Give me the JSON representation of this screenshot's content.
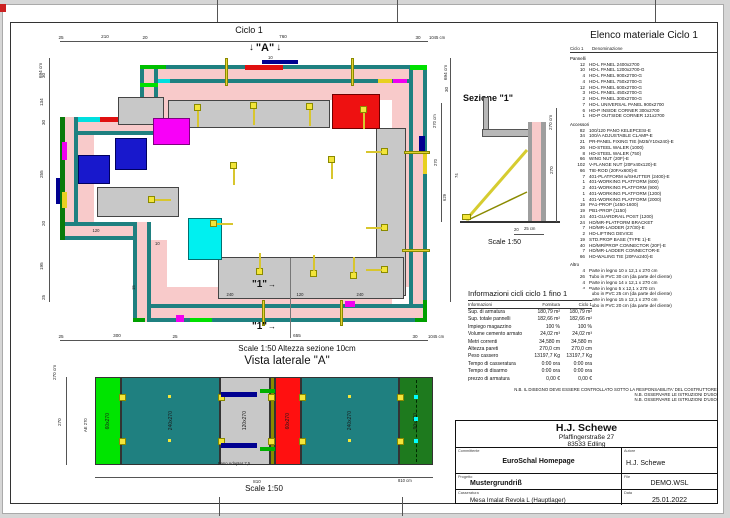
{
  "colors": {
    "teal": "#1F8080",
    "wall_pink": "#F8CACA",
    "bright_green": "#00E000",
    "dark_green": "#1E7A1E",
    "red": "#E01010",
    "magenta": "#F000F0",
    "blue": "#1818CC",
    "navy": "#000090",
    "cyan": "#00E0E0",
    "yellow": "#F3E53A",
    "platform_gray": "#C8C8C8",
    "olive": "#8A8A00"
  },
  "icons": {
    "down_arrow": "↓",
    "right_arrow": "→"
  },
  "sheet": {
    "title_top": "Ciclo 1"
  },
  "plan": {
    "marker_a": "\"A\"",
    "marker_a_dim": "10",
    "marker_1": "\"1\"",
    "top_segs": [
      "25",
      "210",
      "20",
      "760",
      "30"
    ],
    "top_total": "1045 cm",
    "left_total": "694 cm",
    "left_segs": [
      "30",
      "134",
      "30",
      "255",
      "20",
      "195",
      "25"
    ],
    "right_labels": [
      "694 cm",
      "30",
      "270 cm",
      "270",
      "629",
      "74"
    ],
    "bottom_segs": [
      "25",
      "300",
      "25",
      "655",
      "30"
    ],
    "bottom_total": "1045 cm",
    "micro_dims": [
      "10",
      "15",
      "120",
      "240",
      "120",
      "240"
    ],
    "scale_note": "Scale 1:50   Altezza sezione 10cm"
  },
  "sezione": {
    "title": "Sezione \"1\"",
    "dim_total": "270 cm",
    "dim_seg": "270",
    "dim_bottom_a": "20",
    "dim_bottom_b": "25 cm",
    "scale": "Scale 1:50"
  },
  "vista": {
    "title": "Vista laterale \"A\"",
    "panel_labels": [
      "60x270",
      "240x270",
      "120x270",
      "60x270",
      "240x270",
      "90x270"
    ],
    "left_label": "AE 270",
    "left_total": "270 cm",
    "left_seg": "270",
    "bottom_seg": "810",
    "bottom_total": "810 cm",
    "adapter_note": "Pano Adapter 7,5",
    "scale": "Scale 1:50"
  },
  "materials": {
    "title": "Elenco materiale  Ciclo 1",
    "header_col1": "Ciclo 1",
    "header_col2": "Denominazione",
    "groups": [
      {
        "name": "Pannelli",
        "items": [
          {
            "q": "12",
            "n": "HD-L PANEL 2400x2700"
          },
          {
            "q": "10",
            "n": "HD-L PANEL 1200x2700-G"
          },
          {
            "q": "4",
            "n": "HD-L PANEL 900x2700-G"
          },
          {
            "q": "4",
            "n": "HD-L PANEL 750x2700-G"
          },
          {
            "q": "12",
            "n": "HD-L PANEL 600x2700-G"
          },
          {
            "q": "3",
            "n": "HD-L PANEL 450x2700-G"
          },
          {
            "q": "2",
            "n": "HD-L PANEL 300x2700-G"
          },
          {
            "q": "7",
            "n": "HD-L UNIVERSAL PANEL 900x2700"
          },
          {
            "q": "6",
            "n": "HD-P INSIDE CORNER 300x2700"
          },
          {
            "q": "1",
            "n": "HD-P OUTSIDE CORNER 121x2700"
          }
        ]
      },
      {
        "name": "Accessori",
        "items": [
          {
            "q": "82",
            "n": "100/120 PANO KELEPCESI-E"
          },
          {
            "q": "34",
            "n": "100/A ADJUSTABLE CLAMP-E"
          },
          {
            "q": "21",
            "n": "PR-PANEL FIXING TIE (M25/Y10x240)-E"
          },
          {
            "q": "26",
            "n": "HD-STEEL WALER (1000)"
          },
          {
            "q": "8",
            "n": "HD-STEEL WALER (750)"
          },
          {
            "q": "66",
            "n": "WING NUT (20F)-E"
          },
          {
            "q": "102",
            "n": "V-FLANGE NUT (20Fx40x120)-E"
          },
          {
            "q": "66",
            "n": "TIE-ROD (20FAx600)-E"
          },
          {
            "q": "7",
            "n": "401-PLATFORM w/SHUTTER (2400)-E"
          },
          {
            "q": "1",
            "n": "401-WORKING PLATFORM (600)"
          },
          {
            "q": "2",
            "n": "401-WORKING PLATFORM (900)"
          },
          {
            "q": "1",
            "n": "401-WORKING PLATFORM (1200)"
          },
          {
            "q": "1",
            "n": "401-WORKING PLATFORM (2000)"
          },
          {
            "q": "19",
            "n": "PA1-PROP (1450-1600)"
          },
          {
            "q": "19",
            "n": "PB1-PROP (1150)"
          },
          {
            "q": "24",
            "n": "401-GUARDRAIL POST (1200)"
          },
          {
            "q": "24",
            "n": "HD/MR-PLATFORM BRACKET"
          },
          {
            "q": "7",
            "n": "HD/MR-LADDER (27/30)-E"
          },
          {
            "q": "2",
            "n": "HD-LIFTING DEVICE"
          },
          {
            "q": "19",
            "n": "STD.PROP BASE (TYPE 1)-E"
          },
          {
            "q": "40",
            "n": "HD/MR/PROP CONNECTOR (20F)-E"
          },
          {
            "q": "7",
            "n": "HD/MR-LADDER CONNECTOR-E"
          },
          {
            "q": "66",
            "n": "HD-WALING TIE (20FAx240)-E"
          }
        ]
      },
      {
        "name": "Altro",
        "items": [
          {
            "q": "4",
            "n": "Parte in legno 10 x 12,1 x 270 cm"
          },
          {
            "q": "26",
            "n": "Tubo in PVC 30 cm (da parte del cliente)"
          },
          {
            "q": "4",
            "n": "Parte in legno 14 x 12,1 x 270 cm"
          },
          {
            "q": "4",
            "n": "Parte in legno 5 x 12,1 x 270 cm"
          },
          {
            "q": "30",
            "n": "Tubo in PVC 25 cm (da parte del cliente)"
          },
          {
            "q": "5",
            "n": "Parte in legno 15 x 12,1 x 270 cm"
          },
          {
            "q": "10",
            "n": "Tubo in PVC 20 cm (da parte del cliente)"
          }
        ]
      }
    ]
  },
  "info": {
    "title": "Informazioni cicli  ciclo 1 fino 1",
    "headers": [
      "Informazioni",
      "Fornitura",
      "Ciclo 1"
    ],
    "rows": [
      [
        "Sup. di armatura",
        "180,79 m²",
        "180,79 m²"
      ],
      [
        "Sup. totale pannelli",
        "182,66 m²",
        "182,66 m²"
      ],
      [
        "Impiego magazzino",
        "100 %",
        "100 %"
      ],
      [
        "Volume cemento armato",
        "24,02 m³",
        "24,02 m³"
      ],
      [
        "Metri correnti",
        "34,580 m",
        "34,580 m"
      ],
      [
        "Altezza pareti",
        "270,0 cm",
        "270,0 cm"
      ],
      [
        "Peso cassero",
        "13197,7 Kg",
        "13197,7 Kg"
      ],
      [
        "Tempo di casseratura",
        "0:00 ora",
        "0:00 ora"
      ],
      [
        "Tempo di disarmo",
        "0:00 ora",
        "0:00 ora"
      ],
      [
        "prezzo di armatura",
        "0,00 €",
        "0,00 €"
      ]
    ]
  },
  "notes": [
    "N.B. IL DISEGNO DEVE ESSERE CONTROLLATO SOTTO LA RESPONSABILITA' DEL COSTRUTTORE!",
    "N.B. OSSERVARE LE ISTRUZIONI D'USO!",
    "N.B. OSSERVARE LE ISTRUZIONI D'USO!"
  ],
  "titleblock": {
    "company": "H.J. Schewe",
    "address_line1": "Pfaffingerstraße 27",
    "address_line2": "83533 Edling",
    "committente_label": "Committente",
    "committente": "EuroSchal Homepage",
    "autore_label": "Autore",
    "autore": "H.J. Schewe",
    "progetto_label": "Progetto",
    "progetto": "Mustergrundriß",
    "file_label": "File",
    "file": "DEMO.WSL",
    "casseratura_label": "Casseratura",
    "casseratura": "Mesa Imalat Revola L (Hauptlager)",
    "data_label": "Data",
    "data": "25.01.2022"
  }
}
